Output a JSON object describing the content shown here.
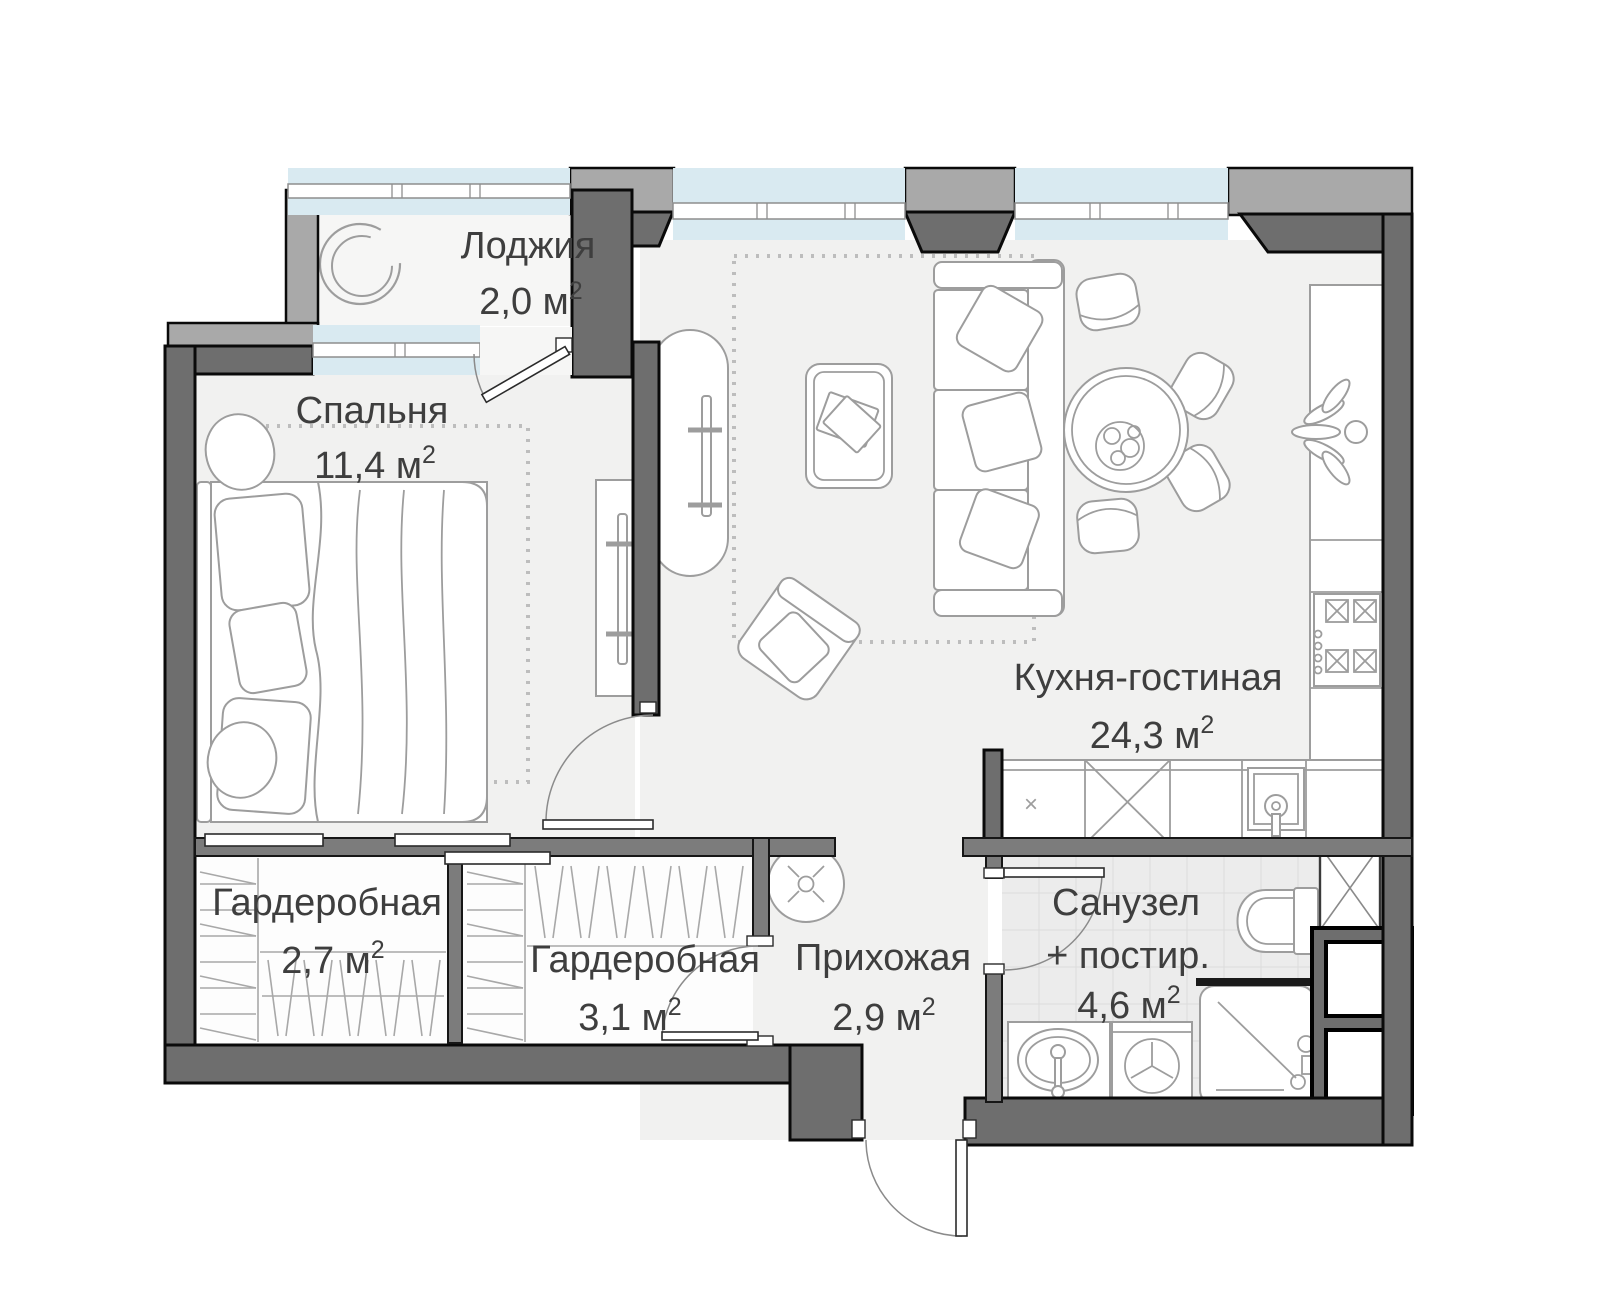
{
  "plan": {
    "title": "apartment-floor-plan",
    "units": {
      "base": " м",
      "sup": "2"
    },
    "rooms": [
      {
        "id": "loggia",
        "name": "Лоджия",
        "area": "2,0"
      },
      {
        "id": "bedroom",
        "name": "Спальня",
        "area": "11,4"
      },
      {
        "id": "kitchen-living",
        "name": "Кухня-гостиная",
        "area": "24,3"
      },
      {
        "id": "wardrobe-1",
        "name": "Гардеробная",
        "area": "2,7"
      },
      {
        "id": "wardrobe-2",
        "name": "Гардеробная",
        "area": "3,1"
      },
      {
        "id": "hallway",
        "name": "Прихожая",
        "area": "2,9"
      },
      {
        "id": "bathroom",
        "name_line1": "Санузел",
        "name_line2": "+ постир.",
        "area": "4,6"
      }
    ],
    "symbols": {
      "cabinet_mark": "×"
    },
    "colors": {
      "wall_dark": "#6e6e6e",
      "wall_light": "#a9a9a9",
      "glass": "#d9eaf1",
      "floor": "#f1f1f0",
      "tile": "#ececec"
    }
  }
}
